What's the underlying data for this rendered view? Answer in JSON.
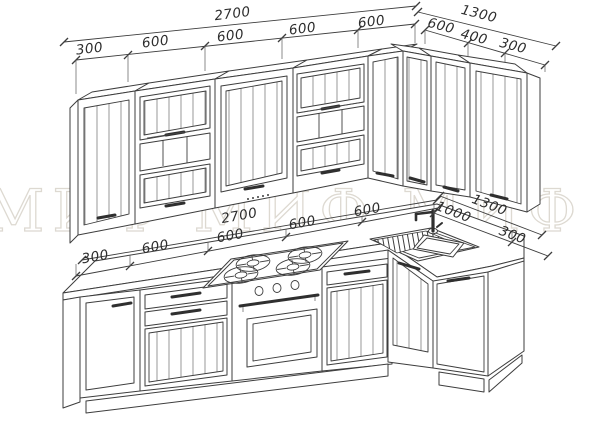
{
  "drawing_title": "L-shaped kitchen set, perspective technical drawing",
  "watermark": {
    "text": "МИФ  МИФ  МИФ  МИФ",
    "color": "#ddd9d1"
  },
  "colors": {
    "line": "#3d3d3d",
    "background": "#ffffff",
    "dim_text": "#2d2d2d"
  },
  "dimensions": {
    "upper_run": {
      "total": "2700",
      "segments": [
        "300",
        "600",
        "600",
        "600",
        "600"
      ]
    },
    "upper_return": {
      "total": "1300",
      "segments": [
        "600",
        "400",
        "300"
      ]
    },
    "base_run": {
      "total": "2700",
      "segments": [
        "300",
        "600",
        "600",
        "600",
        "600"
      ]
    },
    "base_return": {
      "total": "1300",
      "segments": [
        "1000",
        "300"
      ]
    }
  },
  "fixtures": {
    "hob": "4-burner gas hob",
    "oven": "built-in oven",
    "sink": "corner sink with drainer",
    "faucet": "single-lever faucet"
  }
}
